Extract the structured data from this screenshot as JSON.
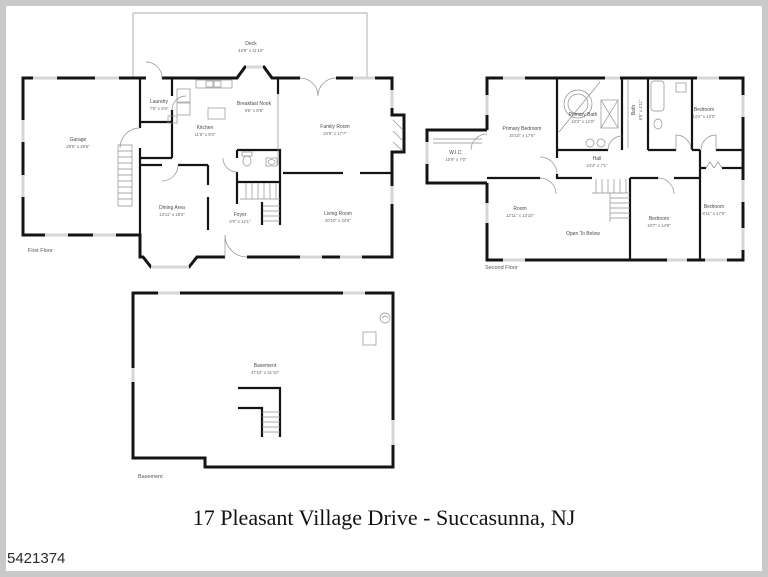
{
  "photo_id": "5421374",
  "title": "17 Pleasant Village Drive - Succasunna, NJ",
  "floors": {
    "first": {
      "caption": "First Floor",
      "rooms": {
        "deck": {
          "name": "Deck",
          "dims": "43'8\" x 11'10\""
        },
        "garage": {
          "name": "Garage",
          "dims": "29'5\" x 29'5\""
        },
        "family_room": {
          "name": "Family Room",
          "dims": "20'8\" x 17'7\""
        },
        "breakfast_nook": {
          "name": "Breakfast Nook",
          "dims": "9'6\" x 8'9\""
        },
        "kitchen": {
          "name": "Kitchen",
          "dims": "11'6\" x 9'4\""
        },
        "laundry": {
          "name": "Laundry",
          "dims": "7'5\" x 5'6\""
        },
        "dining_area": {
          "name": "Dining Area",
          "dims": "13'11\" x 18'3\""
        },
        "living_room": {
          "name": "Living Room",
          "dims": "20'10\" x 24'5\""
        },
        "foyer": {
          "name": "Foyer",
          "dims": "6'6\" x 12'1\""
        }
      }
    },
    "second": {
      "caption": "Second Floor",
      "rooms": {
        "wic": {
          "name": "W.I.C.",
          "dims": "10'9\" x 7'0\""
        },
        "primary_bedroom": {
          "name": "Primary Bedroom",
          "dims": "15'10\" x 17'6\""
        },
        "primary_bath": {
          "name": "Primary Bath",
          "dims": "10'2\" x 12'0\""
        },
        "bath": {
          "name": "Bath",
          "dims": "8'5\" x 4'11\""
        },
        "hall": {
          "name": "Hall",
          "dims": "24'4\" x 7'1\""
        },
        "bedroom_top_right": {
          "name": "Bedroom",
          "dims": "14'4\" x 13'0\""
        },
        "bedroom_right": {
          "name": "Bedroom",
          "dims": "9'11\" x 17'6\""
        },
        "bedroom_middle": {
          "name": "Bedroom",
          "dims": "10'7\" x 14'8\""
        },
        "room": {
          "name": "Room",
          "dims": "12'11\" x 13'10\""
        },
        "open_to_below": {
          "name": "Open To Below"
        }
      }
    },
    "basement": {
      "caption": "Basement",
      "rooms": {
        "basement": {
          "name": "Basement",
          "dims": "47'10\" x 31'10\""
        }
      }
    }
  },
  "colors": {
    "wall": "#141414",
    "thin_line": "#8f8f8f",
    "window": "#d6d6d6",
    "frame_border": "#c9c9c9"
  }
}
